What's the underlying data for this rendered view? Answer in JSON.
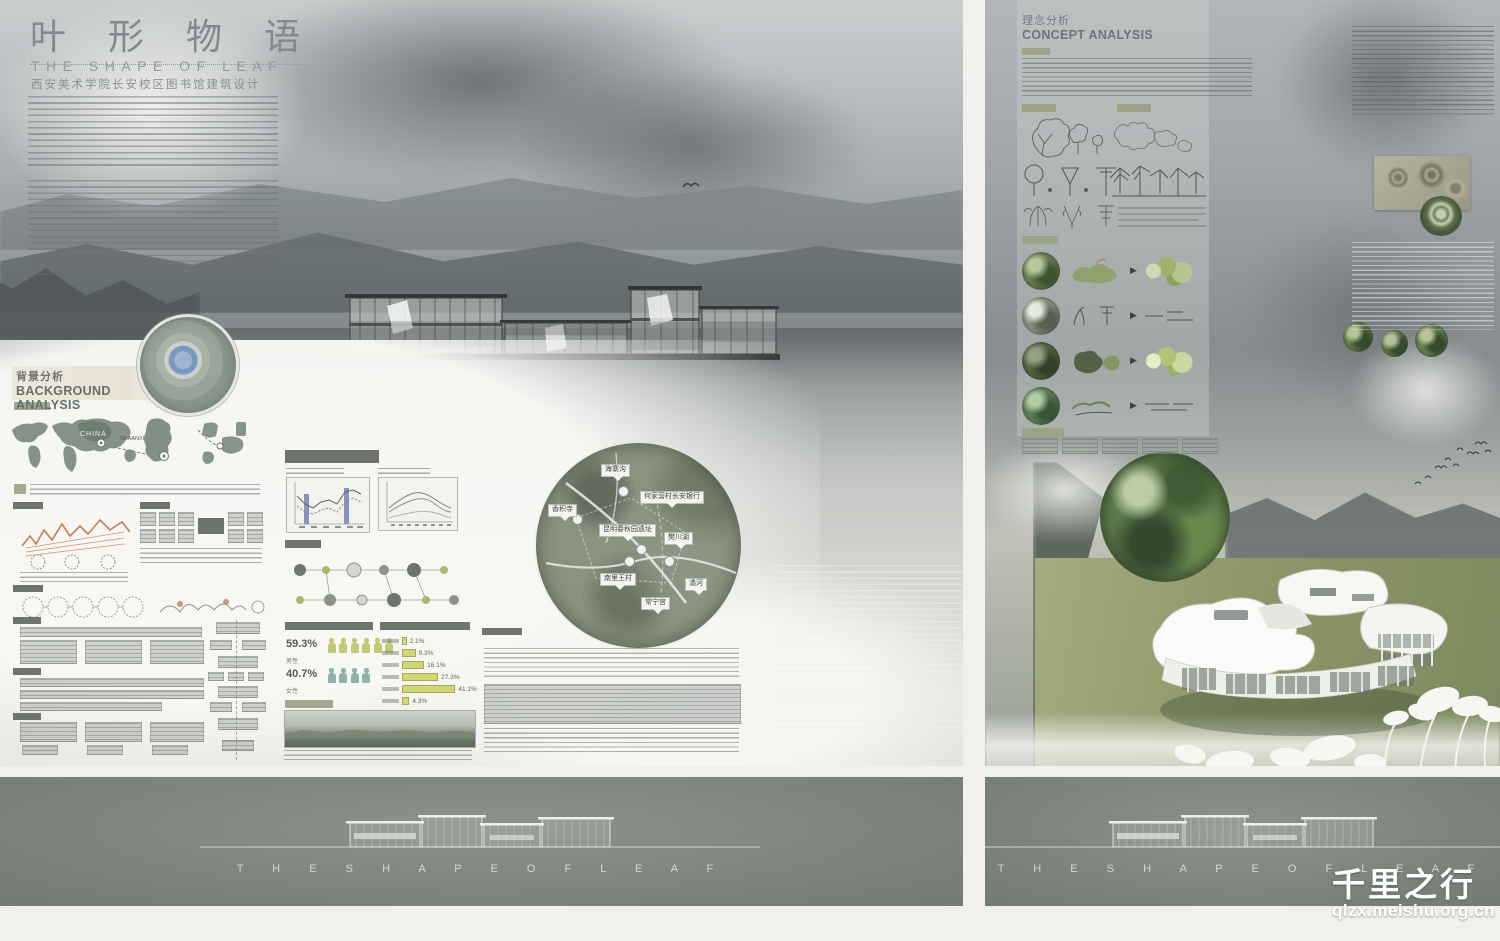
{
  "watermark": {
    "brand": "千里之行",
    "site": "qlzx.meishu.org.cn"
  },
  "left_board": {
    "title_cn": "叶 形 物 语",
    "title_en": "THE SHAPE OF LEAF",
    "subtitle": "西安美术学院长安校区图书馆建筑设计",
    "section": {
      "cn": "背景分析",
      "en": "BACKGROUND ANALYSIS"
    },
    "maps": {
      "china_label": "CHINA",
      "shaanxi_label": "SHAANXI",
      "xian_label": "XI'AN"
    },
    "site_callouts": [
      {
        "label": "海寨沟"
      },
      {
        "label": "何家营村长安银行"
      },
      {
        "label": "香积寺"
      },
      {
        "label": "昆明春秋园遗址"
      },
      {
        "label": "樊川湖"
      },
      {
        "label": "南里王村"
      },
      {
        "label": "潏河"
      },
      {
        "label": "常宁宫"
      }
    ],
    "gender_split": {
      "male_pct": "59.3%",
      "male_note": "男性",
      "female_pct": "40.7%",
      "female_note": "女性"
    },
    "age_chart": {
      "type": "bar",
      "orientation": "horizontal",
      "values": [
        2.1,
        9.3,
        16.1,
        27.3,
        41.1,
        4.3
      ],
      "labels": [
        "2.1%",
        "9.3%",
        "16.1%",
        "27.3%",
        "41.1%",
        "4.3%"
      ]
    }
  },
  "right_board": {
    "section": {
      "cn": "理念分析",
      "en": "CONCEPT ANALYSIS"
    }
  },
  "footer": {
    "strip_title": "T H E   S H A P E   O F   L E A F"
  },
  "colors": {
    "accent_olive": "#9aa183",
    "accent_yellow": "#c2c873",
    "accent_teal": "#8fb2ab",
    "accent_blue": "#8a92c0",
    "sketch_orange": "#c97a52",
    "strip_bg": "#7d857e"
  }
}
